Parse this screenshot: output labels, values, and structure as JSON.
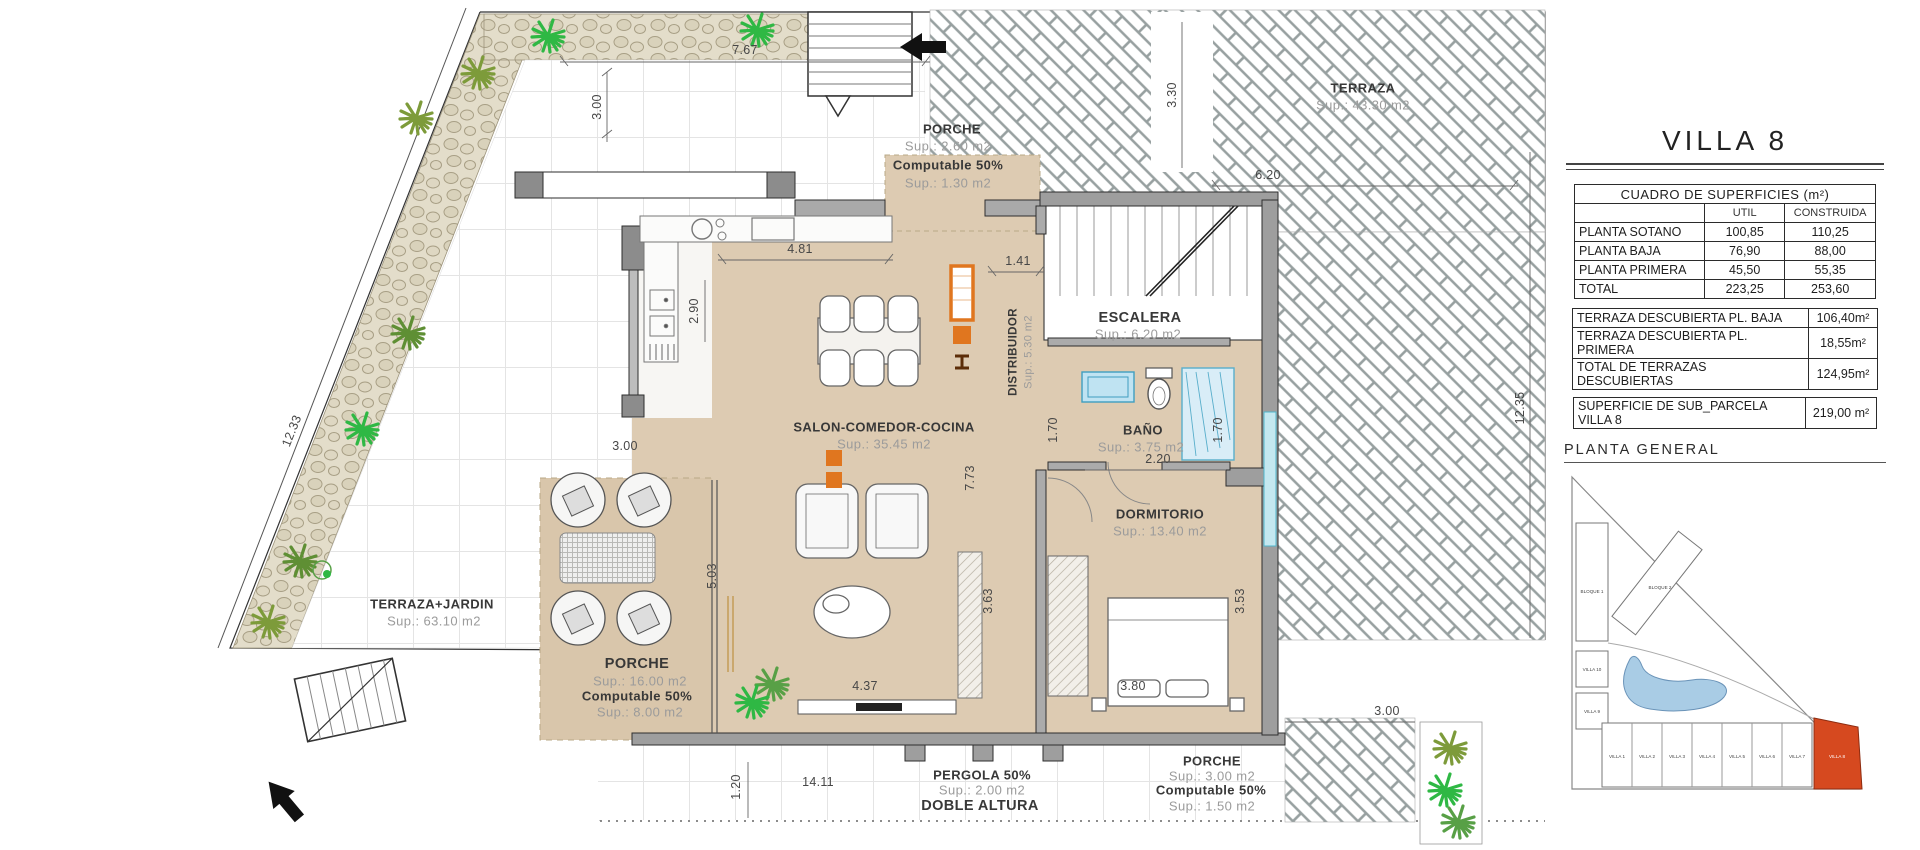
{
  "plan": {
    "rooms": {
      "porche_top": {
        "name": "PORCHE",
        "sup": "Sup.: 2.60   m2",
        "computable": "Computable 50%",
        "computable_sup": "Sup.: 1.30   m2"
      },
      "terraza_top": {
        "name": "TERRAZA",
        "sup": "Sup.: 43.30 m2"
      },
      "salon": {
        "name": "SALON-COMEDOR-COCINA",
        "sup": "Sup.: 35.45 m2"
      },
      "distribuidor": {
        "name": "DISTRIBUIDOR",
        "sup": "Sup.: 5.30  m2"
      },
      "escalera": {
        "name": "ESCALERA",
        "sup": "Sup.: 6.20   m2"
      },
      "bano": {
        "name": "BAÑO",
        "sup": "Sup.: 3.75   m2"
      },
      "dormitorio": {
        "name": "DORMITORIO",
        "sup": "Sup.: 13.40  m2"
      },
      "terraza_jardin": {
        "name": "TERRAZA+JARDIN",
        "sup": "Sup.: 63.10  m2"
      },
      "porche_left": {
        "name": "PORCHE",
        "sup": "Sup.: 16.00  m2",
        "computable": "Computable 50%",
        "computable_sup": "Sup.:  8.00   m2"
      },
      "pergola": {
        "name": "PERGOLA 50%",
        "sup": "Sup.: 2.00   m2",
        "extra": "DOBLE ALTURA"
      },
      "porche_bottom": {
        "name": "PORCHE",
        "sup": "Sup.: 3.00   m2",
        "computable": "Computable 50%",
        "computable_sup": "Sup.: 1.50   m2"
      }
    },
    "dims": {
      "top_width": "7.67",
      "top_depth": "3.00",
      "left_boundary": "12.33",
      "terrace_width": "6.20",
      "terrace_depth": "3.30",
      "kitchen_width": "4.81",
      "kitchen_depth": "2.90",
      "hall_width": "1.41",
      "salon_left": "3.00",
      "bath_width": "2.20",
      "bath_left": "1.70",
      "bath_right": "1.70",
      "salon_height": "7.73",
      "salon_bottom": "3.63",
      "bedroom_bottom": "3.53",
      "porch_height": "5.03",
      "salon_width": "4.37",
      "bedroom_width": "3.80",
      "bottom_width": "14.11",
      "bottom_offset": "1.20",
      "right_bottom": "3.00",
      "right_boundary": "12.35"
    }
  },
  "panel": {
    "title": "VILLA 8",
    "surfaces": {
      "header": "CUADRO DE SUPERFICIES (m²)",
      "col_util": "UTIL",
      "col_construida": "CONSTRUIDA",
      "rows": [
        {
          "label": "PLANTA SOTANO",
          "util": "100,85",
          "construida": "110,25"
        },
        {
          "label": "PLANTA BAJA",
          "util": "76,90",
          "construida": "88,00"
        },
        {
          "label": "PLANTA PRIMERA",
          "util": "45,50",
          "construida": "55,35"
        },
        {
          "label": "TOTAL",
          "util": "223,25",
          "construida": "253,60"
        }
      ]
    },
    "terraces": {
      "rows": [
        {
          "label": "TERRAZA DESCUBIERTA PL. BAJA",
          "value": "106,40m²"
        },
        {
          "label": "TERRAZA DESCUBIERTA PL. PRIMERA",
          "value": "18,55m²"
        },
        {
          "label": "TOTAL DE TERRAZAS DESCUBIERTAS",
          "value": "124,95m²"
        }
      ]
    },
    "parcel": {
      "label": "SUPERFICIE DE SUB_PARCELA VILLA 8",
      "value": "219,00 m²"
    },
    "site": {
      "title": "PLANTA GENERAL",
      "bloque1": "BLOQUE 1",
      "bloque2": "BLOQUE 2",
      "villa10": "VILLA 10",
      "villa9": "VILLA 9",
      "row": [
        "VILLA 1",
        "VILLA 2",
        "VILLA 3",
        "VILLA 4",
        "VILLA 5",
        "VILLA 6",
        "VILLA 7"
      ],
      "highlight": "VILLA 8"
    }
  },
  "colors": {
    "floor_beige": "#ddcbb2",
    "accent_orange": "#e0761f",
    "fixture_blue": "#bfe3f2",
    "wall_gray": "#9a9a9a",
    "site_highlight": "#d6491f",
    "pool_blue": "#a9cce5"
  }
}
